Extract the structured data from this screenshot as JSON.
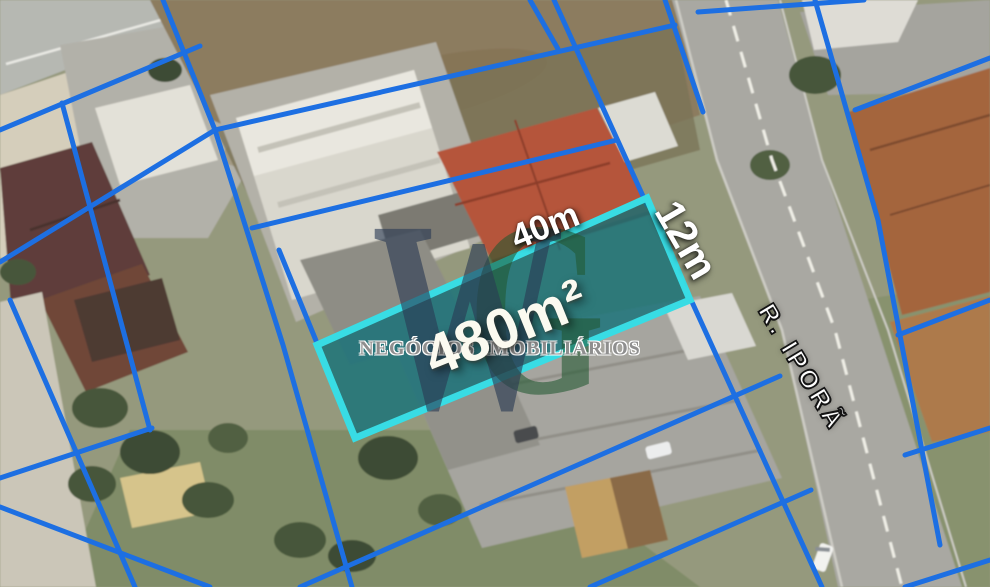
{
  "parcel": {
    "area": "480m²",
    "frontage": "40m",
    "depth": "12m"
  },
  "street": {
    "name": "R. IPORÃ"
  },
  "watermark": {
    "letter_w": "W",
    "letter_g": "G",
    "agency": "NEGÓCIOS IMOBILIÁRIOS"
  },
  "colors": {
    "boundary_line": "#1d6fe2",
    "parcel_fill": "#147078",
    "parcel_border": "#38dce4",
    "road_marking": "#efeee6"
  }
}
